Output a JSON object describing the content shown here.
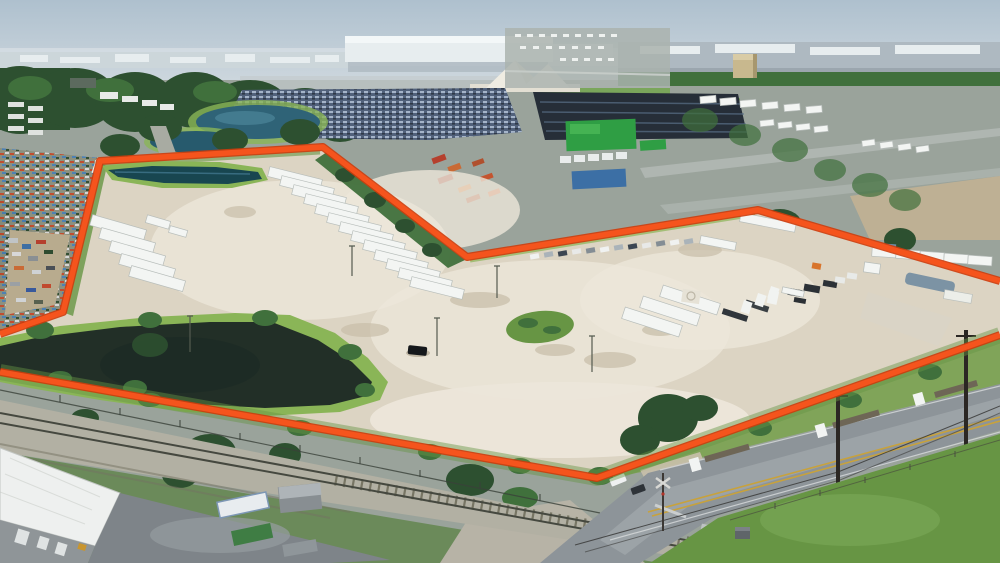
{
  "meta": {
    "caption": "Aerial drone photograph of an industrial dirt truck-yard parcel outlined with a thick orange boundary line, surrounded by truck depots, retention ponds, a railroad track and a frontage road",
    "image_type": "photograph",
    "visible_text": []
  },
  "palette": {
    "sky_top": "#aec0ce",
    "sky_low": "#ccd6dd",
    "haze": "#e3e8eb",
    "skyline_gray": "#8fa4b2",
    "distant_band": "#ccd6da",
    "warehouse_white": "#e7edef",
    "warehouse_gray": "#aeb9c1",
    "tree_dark": "#2d5030",
    "tree_mid": "#40703c",
    "grass": "#679544",
    "grass_bright": "#8ab557",
    "field_green": "#7aa65b",
    "dirt": "#dcd4c3",
    "dirt_light": "#ece6da",
    "dirt_shadow": "#c7bda8",
    "water_blue": "#2f6377",
    "pond_deep": "#184650",
    "pond_dark": "#222f27",
    "boundary_orange": "#f5541d",
    "boundary_deep": "#cd3c0c",
    "asphalt": "#8d9499",
    "asphalt_light": "#a9afb3",
    "concrete": "#d6d9d9",
    "trailer_white": "#f3f5f3",
    "trailer_edge": "#b7bdba",
    "truck_dark": "#262e38",
    "ballast": "#b2b0a3",
    "rail_steel": "#45483f",
    "tie_brown": "#63624f",
    "road_yellow": "#c8a23c",
    "container_green": "#2f9e44",
    "container_blue": "#3c6fa5",
    "sand": "#efece2",
    "roof_white": "#eef0ef",
    "wall_gray": "#8f9598",
    "carlot_base": "#51617b"
  },
  "boundary": {
    "color": "#f5541d",
    "north_points": "0,334 63,312 100,161 323,147 467,257 758,210 1000,281",
    "south_points": "1000,335 597,478 0,372"
  },
  "scene": {
    "landmarks": [
      {
        "name": "city-skyline",
        "description": "Distant downtown towers on hazy horizon"
      },
      {
        "name": "distribution-warehouse",
        "description": "Large white distribution warehouse at horizon center"
      },
      {
        "name": "aggregate-piles",
        "description": "White sand and gravel stockpiles"
      },
      {
        "name": "car-auction-lot",
        "description": "Dense lot of parked cars upper left-center"
      },
      {
        "name": "truck-depot-rows",
        "description": "Rows of dark semi trucks right of the car lot"
      },
      {
        "name": "retention-ponds",
        "description": "Two blue retention ponds upper left"
      },
      {
        "name": "salvage-yard",
        "description": "Cluttered salvage and truck yards along left edge"
      },
      {
        "name": "subject-parcel",
        "description": "White shell dirt truck yard outlined in orange"
      },
      {
        "name": "parcel-retention-pond",
        "description": "Narrow retention pond inside the northwest corner"
      },
      {
        "name": "trailer-row-northwest",
        "description": "Echelon row of white semi trailers along the northwest fence"
      },
      {
        "name": "trailer-cluster-west",
        "description": "Small cluster of white trailers in the west corner"
      },
      {
        "name": "trailer-group-center",
        "description": "Three white trailers with day-cab trucks near center-east"
      },
      {
        "name": "grass-island",
        "description": "Oval grass island in the middle of the dirt lot"
      },
      {
        "name": "large-pond",
        "description": "Large dark stormwater pond in the south part of the parcel"
      },
      {
        "name": "railroad",
        "description": "Railroad track running along the south edge"
      },
      {
        "name": "frontage-road",
        "description": "Two-lane road with parked flatbed semi trucks, bottom right"
      },
      {
        "name": "rail-crossing",
        "description": "Railroad grade crossing with signal and utility poles"
      },
      {
        "name": "metal-building",
        "description": "White-roofed metal building in the bottom-left corner"
      },
      {
        "name": "storage-containers",
        "description": "Shipping containers and a shed beside the metal building"
      }
    ]
  }
}
